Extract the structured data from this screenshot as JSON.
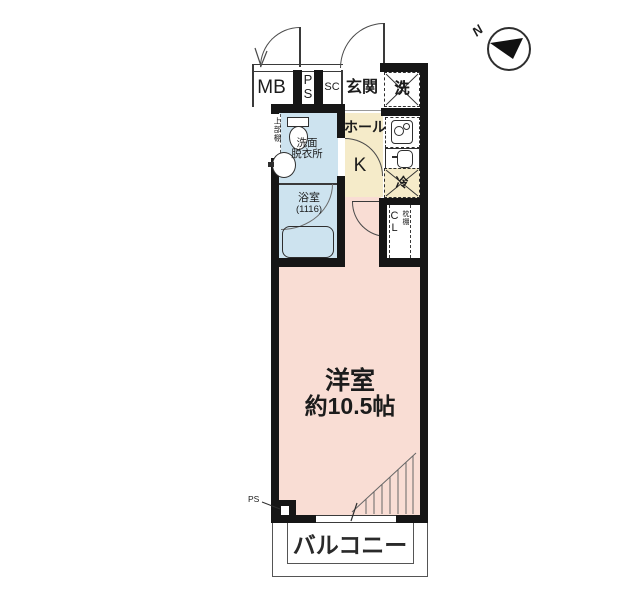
{
  "compass": {
    "label": "N"
  },
  "colors": {
    "wall": "#161616",
    "room_pink": "#f9ddd4",
    "hall_beige": "#f5ebc9",
    "wet_area_blue": "#cde3ef"
  },
  "rooms": {
    "meter_box": {
      "label": "MB"
    },
    "pipe_space_top": {
      "line1": "P",
      "line2": "S"
    },
    "shoe_closet": {
      "label": "SC"
    },
    "entrance": {
      "label": "玄関"
    },
    "laundry": {
      "label": "洗"
    },
    "hall": {
      "label": "ホール"
    },
    "kitchen": {
      "label": "K"
    },
    "refrigerator": {
      "label": "冷"
    },
    "washroom": {
      "line1": "洗面",
      "line2": "脱衣所",
      "shelf_note": "上部棚"
    },
    "bathroom": {
      "label": "浴室",
      "size_note": "(1116)"
    },
    "closet": {
      "line1": "C",
      "line2": "L",
      "shelf_note": "枕棚"
    },
    "main_room": {
      "label": "洋室",
      "size": "約10.5帖"
    },
    "balcony": {
      "label": "バルコニー"
    },
    "pipe_space_bottom": {
      "label": "PS"
    }
  }
}
